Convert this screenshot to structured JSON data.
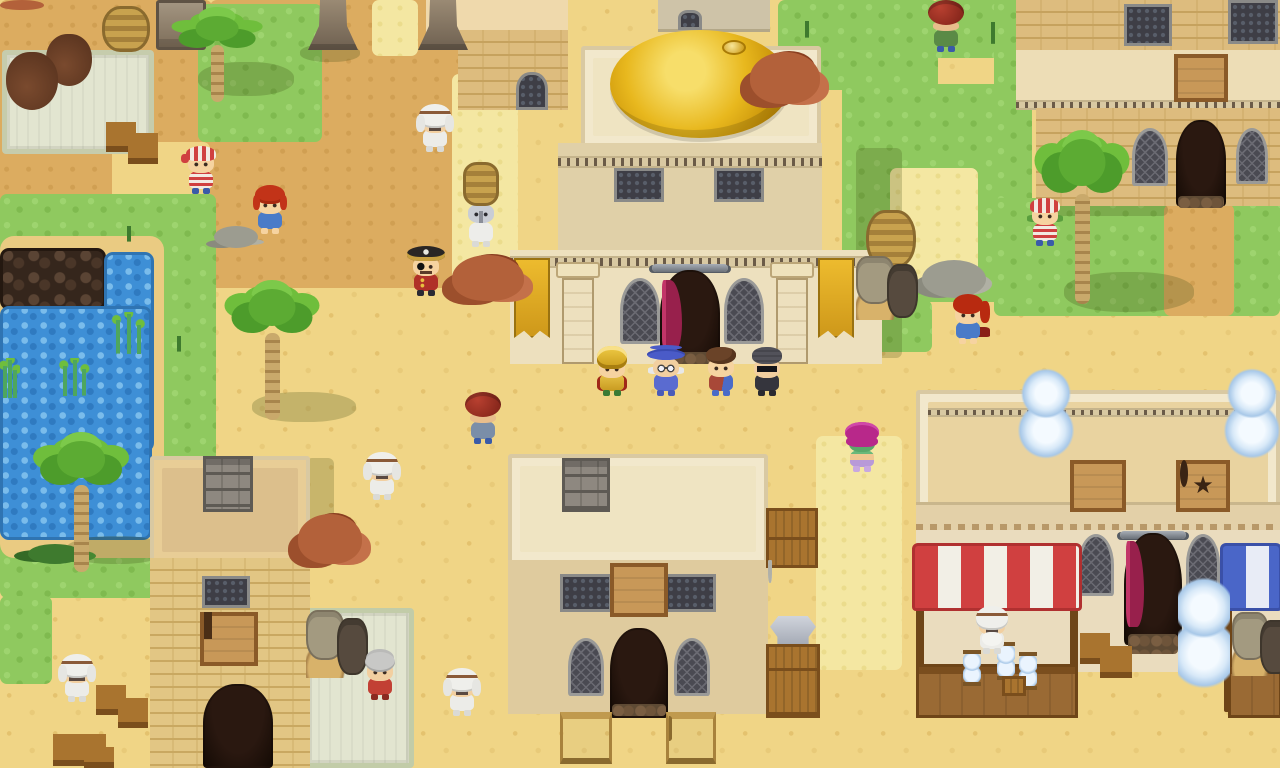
{
  "meta": {
    "scene": "pixel-art desert bazaar town",
    "width": 1280,
    "height": 768
  },
  "palette": {
    "sand": "#F0D586",
    "path_dark": "#DCAC60",
    "grass": "#8FC95F",
    "straw": "#F4E7A2",
    "water": "#3E8FD6",
    "dome_gold": "#E8B81E",
    "awning_red": "#D04040",
    "awning_blue": "#4A66C8",
    "curtain_magenta": "#B32558",
    "wood": "#A9742F",
    "stone": "#9A8A74",
    "banner_gold": "#EDBB2E"
  },
  "signs": {
    "pentagram_glyph": "★",
    "pentagram": "pentacle shop sign",
    "gem": "jewel shop sign",
    "bed": "inn bed sign",
    "anvil": "blacksmith anvil sign",
    "tower_emblem": "tower guild emblem",
    "banner": "gold palm-and-hourglass banner"
  },
  "ground": [
    {
      "name": "path-topleft",
      "cls": "darktan",
      "x": 0,
      "y": 0,
      "w": 212,
      "h": 206
    },
    {
      "name": "path-topcenter",
      "cls": "darktan",
      "x": 210,
      "y": 0,
      "w": 252,
      "h": 288
    },
    {
      "name": "sand-pocket",
      "cls": "sand",
      "x": 112,
      "y": 142,
      "w": 98,
      "h": 66
    },
    {
      "name": "grass-island-topleft",
      "cls": "grass",
      "x": 198,
      "y": 4,
      "w": 124,
      "h": 138
    },
    {
      "name": "straw-statues",
      "cls": "straw",
      "x": 372,
      "y": 0,
      "w": 46,
      "h": 56
    },
    {
      "name": "straw-plaza-strip",
      "cls": "straw",
      "x": 452,
      "y": 74,
      "w": 66,
      "h": 208
    },
    {
      "name": "grass-left",
      "cls": "grass",
      "x": 0,
      "y": 194,
      "w": 216,
      "h": 404
    },
    {
      "name": "grass-left-bottom",
      "cls": "grass",
      "x": 0,
      "y": 596,
      "w": 52,
      "h": 88
    },
    {
      "name": "pond-bank",
      "cls": "bank",
      "x": 0,
      "y": 236,
      "w": 164,
      "h": 322
    },
    {
      "name": "dark-rocks",
      "cls": "rocks",
      "x": 0,
      "y": 248,
      "w": 106,
      "h": 62
    },
    {
      "name": "water-arm",
      "cls": "water",
      "x": 104,
      "y": 252,
      "w": 50,
      "h": 200
    },
    {
      "name": "water-main",
      "cls": "water",
      "x": 0,
      "y": 306,
      "w": 152,
      "h": 234
    },
    {
      "name": "grass-right-of-dome",
      "cls": "grass",
      "x": 778,
      "y": 0,
      "w": 160,
      "h": 90
    },
    {
      "name": "grass-topright",
      "cls": "grass",
      "x": 932,
      "y": 0,
      "w": 94,
      "h": 58
    },
    {
      "name": "grass-right",
      "cls": "grass",
      "x": 842,
      "y": 84,
      "w": 190,
      "h": 218
    },
    {
      "name": "grass-right-tail",
      "cls": "grass",
      "x": 842,
      "y": 300,
      "w": 90,
      "h": 52
    },
    {
      "name": "grass-inn-left",
      "cls": "grass",
      "x": 994,
      "y": 0,
      "w": 30,
      "h": 278
    },
    {
      "name": "grass-inn-front",
      "cls": "grass",
      "x": 994,
      "y": 198,
      "w": 286,
      "h": 118
    },
    {
      "name": "path-inn",
      "cls": "darktan",
      "x": 1164,
      "y": 204,
      "w": 70,
      "h": 112
    },
    {
      "name": "straw-right",
      "cls": "straw",
      "x": 890,
      "y": 168,
      "w": 88,
      "h": 118
    },
    {
      "name": "straw-smithy",
      "cls": "straw",
      "x": 816,
      "y": 436,
      "w": 86,
      "h": 234
    }
  ],
  "shadows": [
    {
      "name": "palm-shadow",
      "cls": "shadow",
      "x": 198,
      "y": 62,
      "w": 96,
      "h": 34
    },
    {
      "name": "palm-shadow",
      "cls": "shadow",
      "x": 252,
      "y": 392,
      "w": 104,
      "h": 30
    },
    {
      "name": "palm-shadow",
      "cls": "shadow",
      "x": 66,
      "y": 536,
      "w": 100,
      "h": 28
    },
    {
      "name": "palm-shadow",
      "cls": "shadow",
      "x": 1064,
      "y": 272,
      "w": 130,
      "h": 40
    },
    {
      "name": "palace-shadow",
      "cls": "rshadow",
      "x": 856,
      "y": 148,
      "w": 46,
      "h": 210
    },
    {
      "name": "tower-shadow",
      "cls": "rshadow",
      "x": 306,
      "y": 458,
      "w": 28,
      "h": 108
    },
    {
      "name": "statue-shadow",
      "cls": "shadow",
      "x": 300,
      "y": 44,
      "w": 60,
      "h": 18
    },
    {
      "name": "inn-shadow",
      "cls": "rshadow",
      "x": 1038,
      "y": 204,
      "w": 130,
      "h": 12
    }
  ],
  "props": [
    {
      "name": "apothecary-rug",
      "type": "rug",
      "x": 2,
      "y": 50,
      "w": 152,
      "h": 104,
      "z": 8,
      "inter": false
    },
    {
      "name": "cooking-pot-orange",
      "type": "potstew",
      "x": 6,
      "y": 52,
      "w": 52,
      "h": 58,
      "vars": {
        "stew": "#DF8A28"
      },
      "inter": true
    },
    {
      "name": "cooking-pot-green",
      "type": "potstew",
      "x": 46,
      "y": 34,
      "w": 46,
      "h": 52,
      "vars": {
        "stew": "#9FB83C"
      },
      "inter": true
    },
    {
      "name": "clay-urn",
      "type": "vase",
      "x": 14,
      "y": 0,
      "w": 32,
      "h": 46,
      "vars": {
        "c": "#C2A596"
      },
      "inter": false
    },
    {
      "name": "basket-stack",
      "type": "basketstack",
      "x": 102,
      "y": 6,
      "w": 48,
      "h": 46,
      "inter": false
    },
    {
      "name": "genie-bottle-blue",
      "type": "genie",
      "x": 96,
      "y": 44,
      "w": 60,
      "h": 60,
      "vars": {
        "c": "#2E7FB8"
      },
      "inter": true
    },
    {
      "name": "genie-bottle-purple",
      "type": "genie",
      "x": 2,
      "y": 100,
      "w": 52,
      "h": 56,
      "vars": {
        "c": "#5B4AA8"
      },
      "inter": true
    },
    {
      "name": "crate-hourglass",
      "type": "cratehg",
      "x": 106,
      "y": 100,
      "w": 30,
      "h": 52,
      "inter": false
    },
    {
      "name": "crate-hourglass",
      "type": "cratehg",
      "x": 128,
      "y": 110,
      "w": 30,
      "h": 54,
      "inter": false
    },
    {
      "name": "stone-slab",
      "type": "slab",
      "x": 156,
      "y": 0,
      "w": 50,
      "h": 50,
      "inter": false
    },
    {
      "name": "palm-tree",
      "type": "palm",
      "x": 166,
      "y": 0,
      "w": 102,
      "h": 102,
      "inter": false
    },
    {
      "name": "stone-pillar",
      "type": "obelisk",
      "x": 308,
      "y": 0,
      "w": 50,
      "h": 50,
      "inter": false
    },
    {
      "name": "stone-pillar",
      "type": "obelisk",
      "x": 418,
      "y": 0,
      "w": 50,
      "h": 50,
      "inter": false
    },
    {
      "name": "clay-pot-rim",
      "type": "rocksclay",
      "x": 0,
      "y": 0,
      "w": 44,
      "h": 10,
      "inter": false
    },
    {
      "name": "pebbles",
      "type": "stones",
      "x": 214,
      "y": 226,
      "w": 44,
      "h": 22,
      "inter": false
    },
    {
      "name": "palm-tree",
      "type": "palm",
      "x": 216,
      "y": 264,
      "w": 112,
      "h": 156,
      "inter": false
    },
    {
      "name": "clay-rocks",
      "type": "rocksclay",
      "x": 750,
      "y": 52,
      "w": 70,
      "h": 52,
      "inter": false
    },
    {
      "name": "clay-rocks",
      "type": "rocksclay",
      "x": 452,
      "y": 255,
      "w": 72,
      "h": 46,
      "inter": false
    },
    {
      "name": "dark-jug",
      "type": "amphora",
      "x": 468,
      "y": 306,
      "w": 32,
      "h": 54,
      "vars": {
        "c": "#6B5848"
      },
      "inter": false
    },
    {
      "name": "copper-vase",
      "type": "amphora",
      "x": 872,
      "y": 150,
      "w": 32,
      "h": 92,
      "vars": {
        "c": "#B06A38"
      },
      "inter": false
    },
    {
      "name": "basket-stack",
      "type": "basketstack",
      "x": 866,
      "y": 210,
      "w": 50,
      "h": 58,
      "inter": false
    },
    {
      "name": "pot-cluster",
      "type": "potgroup",
      "x": 856,
      "y": 256,
      "w": 62,
      "h": 64,
      "inter": false
    },
    {
      "name": "clay-rocks",
      "type": "rocksclay",
      "x": 298,
      "y": 514,
      "w": 64,
      "h": 50,
      "inter": false
    },
    {
      "name": "crate-stack",
      "type": "crates2",
      "x": 766,
      "y": 508,
      "w": 52,
      "h": 60,
      "inter": false
    },
    {
      "name": "clay-table",
      "type": "pottable",
      "x": 768,
      "y": 562,
      "w": 54,
      "h": 62,
      "inter": false
    },
    {
      "name": "armor-piece",
      "type": "armor",
      "x": 770,
      "y": 616,
      "w": 46,
      "h": 36,
      "inter": true
    },
    {
      "name": "crate-stack",
      "type": "crates3",
      "x": 766,
      "y": 644,
      "w": 54,
      "h": 74,
      "inter": false
    },
    {
      "name": "market-rug",
      "type": "rug",
      "x": 304,
      "y": 608,
      "w": 110,
      "h": 160,
      "z": 8,
      "vars": {
        "c1": "#C2CCA8"
      },
      "inter": false
    },
    {
      "name": "pot-cluster",
      "type": "potgroup",
      "x": 306,
      "y": 610,
      "w": 62,
      "h": 68,
      "inter": false
    },
    {
      "name": "genie-bottle-purple",
      "type": "genie",
      "x": 310,
      "y": 660,
      "w": 46,
      "h": 54,
      "vars": {
        "c": "#4A3E9E"
      },
      "inter": true
    },
    {
      "name": "gold-sack",
      "type": "goldsack",
      "x": 304,
      "y": 710,
      "w": 54,
      "h": 58,
      "inter": true
    },
    {
      "name": "gold-sack",
      "type": "goldsack",
      "x": 98,
      "y": 558,
      "w": 52,
      "h": 60,
      "inter": true
    },
    {
      "name": "brown-vase",
      "type": "vase",
      "x": 108,
      "y": 608,
      "w": 32,
      "h": 54,
      "vars": {
        "c": "#8A4A30"
      },
      "inter": false
    },
    {
      "name": "crate-hourglass",
      "type": "cratehg",
      "x": 96,
      "y": 663,
      "w": 30,
      "h": 52,
      "inter": false
    },
    {
      "name": "crate-hourglass",
      "type": "cratehg",
      "x": 118,
      "y": 676,
      "w": 30,
      "h": 52,
      "inter": false
    },
    {
      "name": "crate-hourgl ass",
      "type": "cratehg",
      "x": 53,
      "y": 710,
      "w": 30,
      "h": 56,
      "inter": false
    },
    {
      "name": "crate-hourglass",
      "type": "cratehg",
      "x": 76,
      "y": 710,
      "w": 30,
      "h": 56,
      "inter": false
    },
    {
      "name": "crate-hourglass",
      "type": "cratehg",
      "x": 84,
      "y": 733,
      "w": 30,
      "h": 35,
      "inter": false
    },
    {
      "name": "sword-rack-double",
      "type": "swordrack2",
      "x": 560,
      "y": 712,
      "w": 52,
      "h": 52,
      "inter": true
    },
    {
      "name": "sword-rack-single",
      "type": "swordrack1",
      "x": 666,
      "y": 712,
      "w": 50,
      "h": 52,
      "inter": true
    },
    {
      "name": "rooftop-hourglass",
      "type": "bighourglass",
      "x": 1018,
      "y": 352,
      "w": 56,
      "h": 112,
      "inter": false
    },
    {
      "name": "rooftop-hourglass",
      "type": "bighourglass",
      "x": 1224,
      "y": 352,
      "w": 56,
      "h": 112,
      "inter": false
    },
    {
      "name": "street-hourglass",
      "type": "bighourglass",
      "x": 1178,
      "y": 556,
      "w": 52,
      "h": 140,
      "inter": true
    },
    {
      "name": "crate-hourglass",
      "type": "cratehg",
      "x": 1080,
      "y": 610,
      "w": 30,
      "h": 54,
      "inter": false
    },
    {
      "name": "crate-hourglass",
      "type": "cratehg",
      "x": 1100,
      "y": 622,
      "w": 32,
      "h": 56,
      "inter": false
    },
    {
      "name": "genie-bottle-blue",
      "type": "genie",
      "x": 922,
      "y": 612,
      "w": 54,
      "h": 60,
      "vars": {
        "c": "#2E7FB8"
      },
      "inter": true
    },
    {
      "name": "copper-stall-vase",
      "type": "vase",
      "x": 1028,
      "y": 608,
      "w": 34,
      "h": 60,
      "vars": {
        "c": "#9A5A2A"
      },
      "inter": true
    },
    {
      "name": "hourglass",
      "type": "hourglass",
      "x": 963,
      "y": 650,
      "w": 18,
      "h": 36,
      "inter": true
    },
    {
      "name": "hourglass",
      "type": "hourglass",
      "x": 997,
      "y": 642,
      "w": 18,
      "h": 38,
      "inter": true
    },
    {
      "name": "hourglass",
      "type": "hourglass",
      "x": 1019,
      "y": 652,
      "w": 18,
      "h": 38,
      "inter": true
    },
    {
      "name": "small-crate",
      "type": "crate",
      "x": 1002,
      "y": 676,
      "w": 24,
      "h": 20,
      "inter": false
    },
    {
      "name": "pot-cluster",
      "type": "potgroup",
      "x": 1232,
      "y": 612,
      "w": 58,
      "h": 64,
      "inter": false
    },
    {
      "name": "gray-stones",
      "type": "stones",
      "x": 922,
      "y": 260,
      "w": 64,
      "h": 38,
      "inter": false
    },
    {
      "name": "palm-tree",
      "type": "palm",
      "x": 1026,
      "y": 108,
      "w": 112,
      "h": 196,
      "inter": false
    },
    {
      "name": "palm-tree",
      "type": "palm",
      "x": 24,
      "y": 416,
      "w": 114,
      "h": 156,
      "inter": false
    },
    {
      "name": "stone-chimney",
      "type": "chimney",
      "x": 203,
      "y": 456,
      "w": 50,
      "h": 56,
      "inter": false
    },
    {
      "name": "stone-chimney",
      "type": "chimney",
      "x": 562,
      "y": 458,
      "w": 48,
      "h": 54,
      "inter": false
    },
    {
      "name": "sprout",
      "type": "sprout",
      "x": 106,
      "y": 212,
      "w": 46,
      "h": 30,
      "inter": false
    },
    {
      "name": "sprout",
      "type": "sprout",
      "x": 968,
      "y": 2,
      "w": 50,
      "h": 42,
      "inter": false
    },
    {
      "name": "sprout",
      "type": "sprout",
      "x": 786,
      "y": 6,
      "w": 42,
      "h": 32,
      "inter": false
    },
    {
      "name": "sprout",
      "type": "sprout",
      "x": 0,
      "y": 52,
      "w": 36,
      "h": 38,
      "inter": false
    },
    {
      "name": "sprout",
      "type": "sprout",
      "x": 158,
      "y": 322,
      "w": 42,
      "h": 30,
      "inter": false
    },
    {
      "name": "seaweed",
      "type": "seaweed",
      "x": 110,
      "y": 312,
      "w": 36,
      "h": 42,
      "inter": false
    },
    {
      "name": "seaweed",
      "type": "seaweed",
      "x": 58,
      "y": 358,
      "w": 32,
      "h": 38,
      "inter": false
    },
    {
      "name": "seaweed",
      "type": "seaweed",
      "x": 0,
      "y": 358,
      "w": 20,
      "h": 40,
      "inter": false
    },
    {
      "name": "bush",
      "type": "bush",
      "x": 28,
      "y": 544,
      "w": 54,
      "h": 20,
      "inter": false
    },
    {
      "name": "monkey",
      "type": "monkey",
      "x": 616,
      "y": 462,
      "w": 44,
      "h": 48,
      "inter": true
    }
  ],
  "characters": [
    {
      "name": "pirate-bandana-kid",
      "type": "ch-pirate-kid",
      "x": 181,
      "y": 144,
      "w": 40,
      "h": 52
    },
    {
      "name": "red-haired-girl",
      "type": "ch-girl",
      "x": 250,
      "y": 184,
      "w": 40,
      "h": 52
    },
    {
      "name": "white-robed-elder",
      "type": "ch-elder",
      "x": 414,
      "y": 102,
      "w": 42,
      "h": 52
    },
    {
      "name": "basket-porter",
      "type": "ch-porter",
      "x": 458,
      "y": 162,
      "w": 46,
      "h": 88
    },
    {
      "name": "pirate-captain",
      "type": "ch-captain",
      "x": 404,
      "y": 246,
      "w": 44,
      "h": 62
    },
    {
      "name": "pot-carrier",
      "type": "ch-potcarrier",
      "x": 462,
      "y": 392,
      "w": 42,
      "h": 62,
      "vars": {
        "outfit": "#7A8EA8"
      }
    },
    {
      "name": "white-robed-elder",
      "type": "ch-elder",
      "x": 361,
      "y": 450,
      "w": 42,
      "h": 54
    },
    {
      "name": "golden-knight",
      "type": "ch-knight",
      "x": 590,
      "y": 346,
      "w": 44,
      "h": 56
    },
    {
      "name": "blue-mage",
      "type": "ch-mage",
      "x": 644,
      "y": 346,
      "w": 44,
      "h": 56
    },
    {
      "name": "brown-haired-kid",
      "type": "ch-kid",
      "x": 700,
      "y": 346,
      "w": 42,
      "h": 56
    },
    {
      "name": "hooded-thief",
      "type": "ch-thief",
      "x": 746,
      "y": 346,
      "w": 42,
      "h": 56
    },
    {
      "name": "veiled-dancer",
      "type": "ch-dancer",
      "x": 841,
      "y": 422,
      "w": 42,
      "h": 56
    },
    {
      "name": "red-haired-woman",
      "type": "ch-woman",
      "x": 946,
      "y": 294,
      "w": 44,
      "h": 58
    },
    {
      "name": "striped-bandana-kid",
      "type": "ch-striped-kid",
      "x": 1024,
      "y": 196,
      "w": 42,
      "h": 56
    },
    {
      "name": "pot-carrier",
      "type": "ch-potcarrier",
      "x": 926,
      "y": 0,
      "w": 40,
      "h": 56,
      "vars": {
        "outfit": "#5A8A46"
      }
    },
    {
      "name": "white-robed-elder",
      "type": "ch-elder2",
      "x": 56,
      "y": 652,
      "w": 42,
      "h": 56
    },
    {
      "name": "grandma",
      "type": "ch-grandma",
      "x": 360,
      "y": 650,
      "w": 40,
      "h": 56
    },
    {
      "name": "white-robed-elder",
      "type": "ch-elder",
      "x": 441,
      "y": 666,
      "w": 42,
      "h": 56
    },
    {
      "name": "stall-merchant",
      "type": "ch-merchant",
      "x": 970,
      "y": 604,
      "w": 44,
      "h": 66
    }
  ]
}
